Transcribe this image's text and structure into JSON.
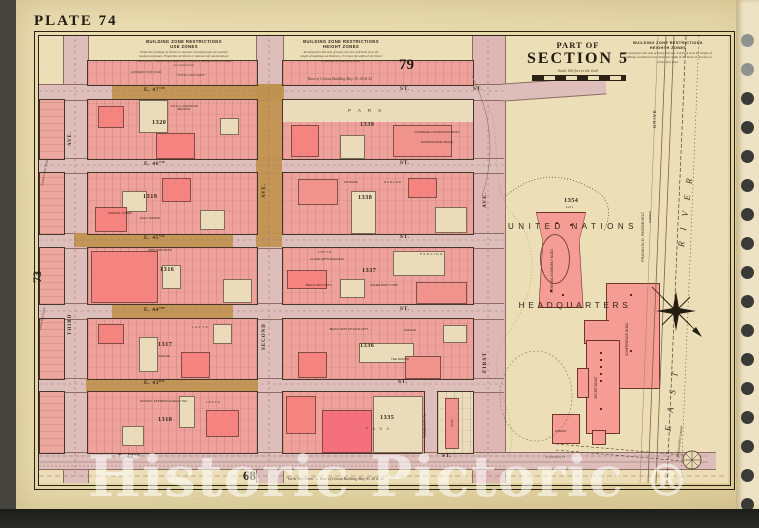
{
  "colors": {
    "paper": "#e8dcae",
    "street_pink": "#ddbebb",
    "zone_tan": "#c0914e",
    "block_pink": "#efa29c",
    "bright_pink": "#f5837f",
    "building_beige": "#eadcba",
    "un_salmon": "#f59c95",
    "ink": "#3a2d1e",
    "watermark": "rgba(255,255,255,0.55)"
  },
  "margins": {
    "plate_title": "PLATE 74",
    "page_top": "79",
    "page_bottom": "68",
    "adjacent_page": "73",
    "watermark": "Historic Pictoric",
    "watermark_reg": "®",
    "margin_note_1": "Eastern Post Road",
    "margin_note_2": "Turtle Bay Farm"
  },
  "title_block": {
    "part_of": "PART OF",
    "section": "SECTION 5",
    "scale": "Scale 160 feet to the Inch"
  },
  "zone_notes": [
    {
      "title": "BUILDING ZONE RESTRICTIONS",
      "subtitle": "USE ZONES",
      "body": "Properties fronting on Streets or Avenues colored purple are used for business purposes. Properties on Streets or Avenues left uncolored are restricted to residences and apartments. Streets or Avenues colored brown are unrestricted.",
      "side_note": "EASTERN POST ROAD",
      "farm_note": "\"TURTLE BAY FARM\""
    },
    {
      "title": "BUILDING ZONE RESTRICTIONS",
      "subtitle": "HEIGHT ZONES",
      "body": "All properties this side of heavy line are restricted as to the height of buildings as limited to 1½ times the width of the Street or Avenue on which they front."
    },
    {
      "title": "BUILDING ZONE RESTRICTIONS",
      "subtitle": "HEIGHTH ZONES",
      "body": "All properties this side of heavy line are restricted as to the height of buildings at limited to two times the width of the Street or Avenue on which they front."
    }
  ],
  "survey_notes": {
    "top": "Base of Census Building   May 30. 28 & 32",
    "bottom": "\"Turtle Bay Farm\"  —  Base of Census Building   May 30. 28 & 32"
  },
  "streets": [
    {
      "name": "E. 47",
      "ord": "TH",
      "st": "ST."
    },
    {
      "name": "E. 46",
      "ord": "TH",
      "st": "ST."
    },
    {
      "name": "E. 45",
      "ord": "TH",
      "st": "ST."
    },
    {
      "name": "E. 44",
      "ord": "TH",
      "st": "ST."
    },
    {
      "name": "E. 43",
      "ord": "RD",
      "st": "ST."
    },
    {
      "name": "E. 42",
      "ord": "ND",
      "st": "ST."
    }
  ],
  "avenues": {
    "ave": "AVE.",
    "third": "THIRD",
    "second": "SECOND",
    "first": "FIRST",
    "tudor": "TUDOR CITY PL."
  },
  "blocks": {
    "b1320": {
      "number": "1320",
      "l0": "Y.M.C.A. RAILROAD BRANCH"
    },
    "b1339": {
      "number": "1339",
      "park": "P A R K",
      "l0": "CARNEGIE FOUNDATION BLDG",
      "l1": "INTERNATIONAL PEACE"
    },
    "b1319": {
      "number": "1319",
      "l0": "CENTRAL TOWER",
      "l1": "DAILY MIRROR"
    },
    "b1338": {
      "number": "1338",
      "l0": "STORAGE",
      "l1": "GARAGE"
    },
    "b1316": {
      "number": "1316",
      "l0": "PRINTERS BLDG"
    },
    "b1337": {
      "number": "1337",
      "l0": "L O F T S",
      "l1": "ALLIED ARTS BUILDING",
      "l2": "BEAUX ARTS APTS",
      "l3": "FISHER BODY CORP.",
      "l4": "PARKING"
    },
    "b1317": {
      "number": "1317",
      "l0": "LOFTS",
      "l1": "GARAGE"
    },
    "b1336": {
      "number": "1336",
      "l0": "BEAUX ARTS STUDIOS APTS",
      "l1": "GARAGE",
      "l2": "THE MANOR"
    },
    "b1318": {
      "number": "1318",
      "l0": "RAILWAY EXPRESS AGENCY INC.",
      "l1": "LOFTS"
    },
    "b1335": {
      "number": "1335",
      "l0": "P A R K",
      "l1": "PARK"
    }
  },
  "un": {
    "block_number": "1354",
    "lot": "Lot 1",
    "line1": "UNITED NATIONS",
    "line2": "HEADQUARTERS",
    "general_assembly": "GENERAL ASSEMBLY BLDG.",
    "conference": "CONFERENCE BLDG.",
    "secretariat": "SECRETARIAT",
    "library": "LIBRARY"
  },
  "waterfront": {
    "drive": "DRIVE",
    "fdr": "FRANKLIN D. ROOSEVELT",
    "under": "(UNDER)",
    "east": "EAST",
    "river": "RIVER",
    "subway": "QUEENSBORO SUBWAY",
    "conduit": "CONDUIT"
  }
}
